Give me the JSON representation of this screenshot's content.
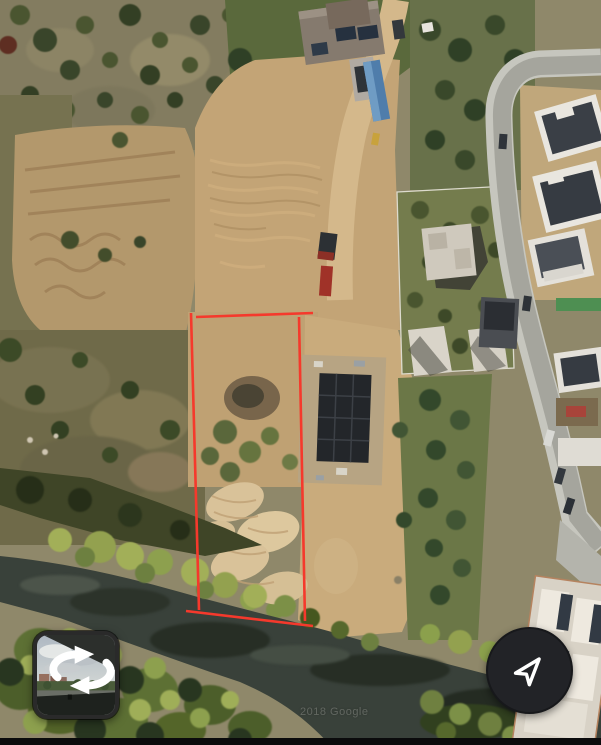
{
  "map": {
    "watermark": "2018 Google",
    "view_type": "satellite"
  },
  "overlays": {
    "parcel": {
      "color": "#f5392c",
      "stroke_width": 2.6,
      "segments": [
        {
          "x1": 191,
          "y1": 313,
          "x2": 199,
          "y2": 610
        },
        {
          "x1": 196,
          "y1": 317,
          "x2": 313,
          "y2": 313
        },
        {
          "x1": 299,
          "y1": 317,
          "x2": 305,
          "y2": 621
        },
        {
          "x1": 186,
          "y1": 611,
          "x2": 313,
          "y2": 626
        }
      ]
    }
  },
  "controls": {
    "streetview": {
      "icon": "streetview-rotate-icon"
    },
    "compass": {
      "icon": "navigation-arrow-icon",
      "background": "#222327",
      "foreground": "#ffffff"
    }
  }
}
